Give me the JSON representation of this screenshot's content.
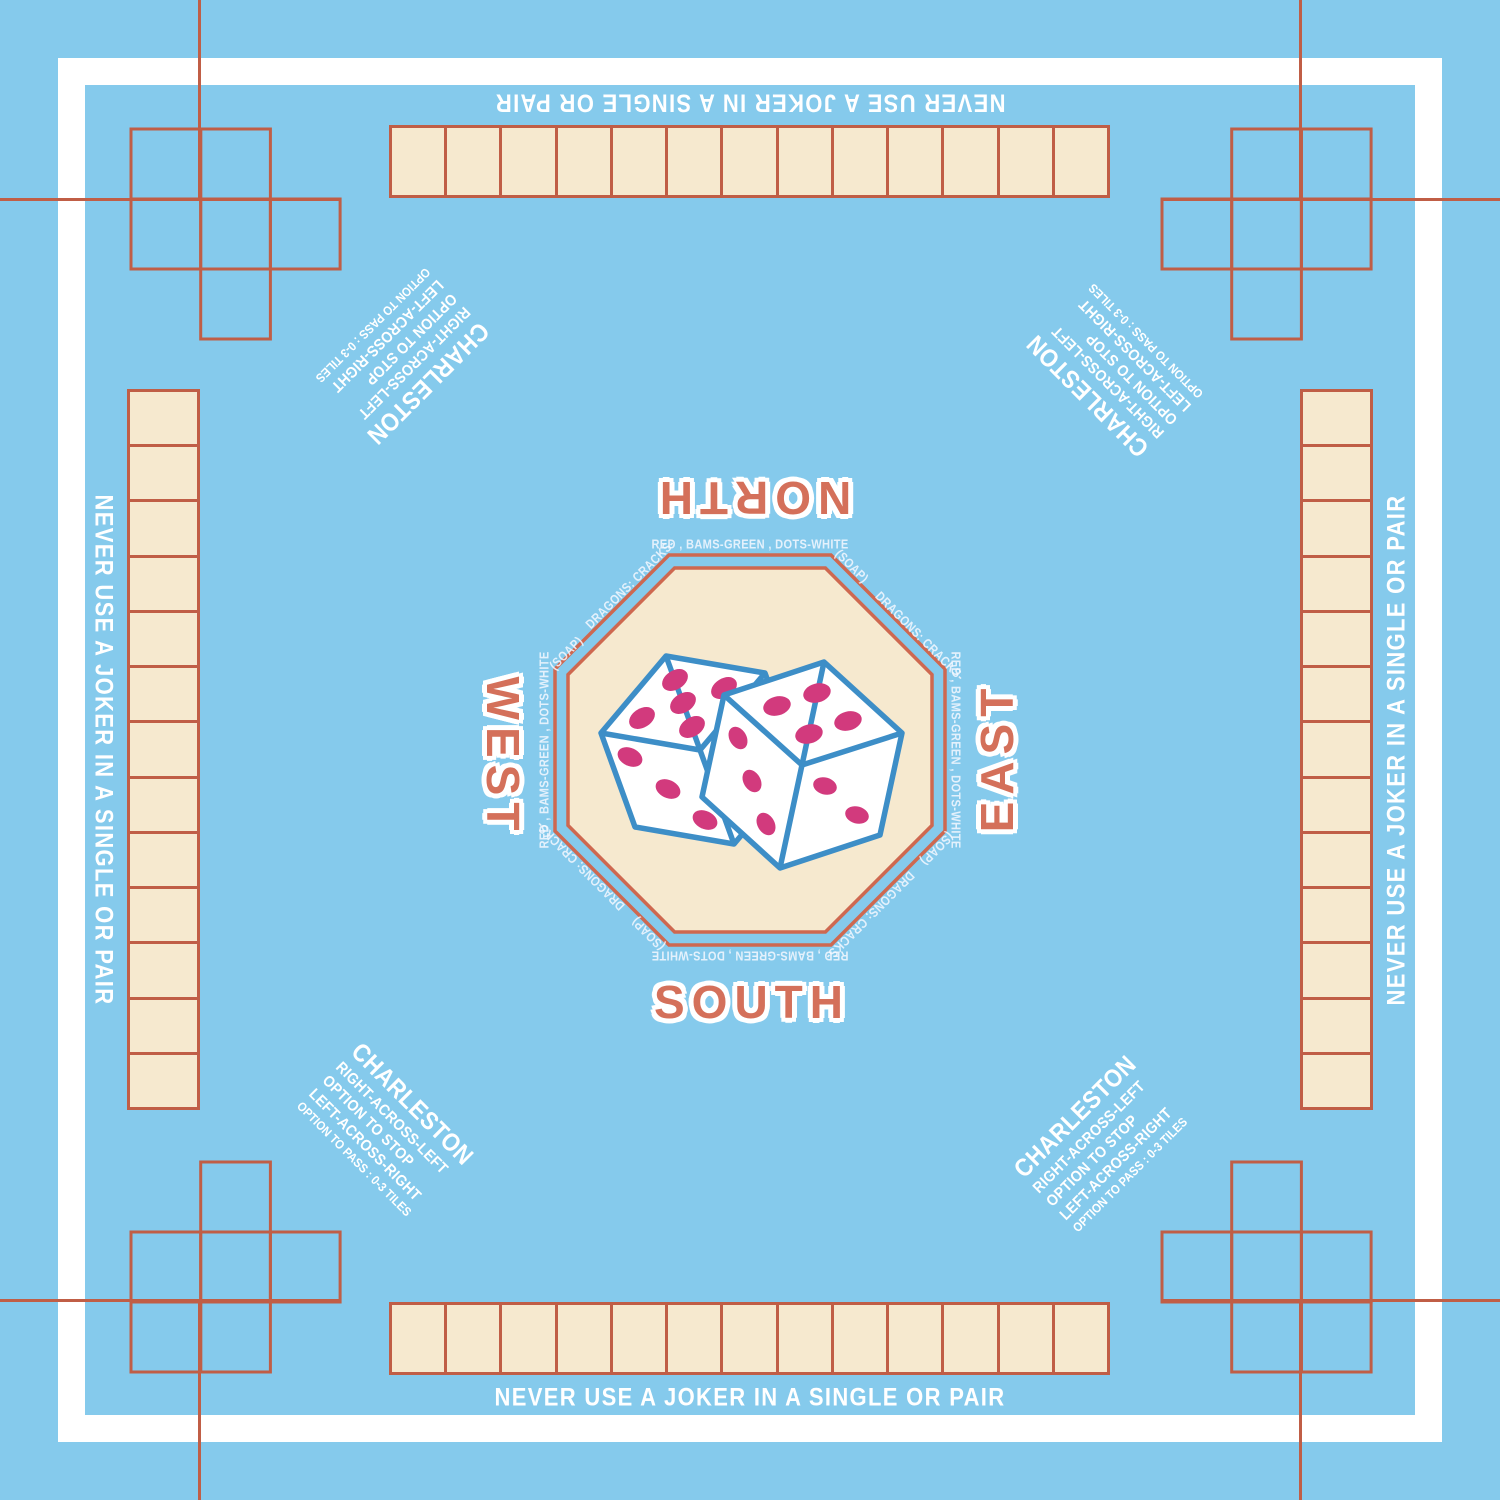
{
  "colors": {
    "background": "#85CAEC",
    "line": "#C05E46",
    "cream": "#F6E9CF",
    "label": "#D4705A",
    "rim": "#CE6850",
    "dice_outline": "#3D8EC7",
    "pip": "#D23A7D",
    "ring_text": "rgba(245,248,255,0.85)"
  },
  "warning": {
    "text": "NEVER USE A JOKER IN A SINGLE OR PAIR"
  },
  "labels": {
    "north": "NORTH",
    "south": "SOUTH",
    "east": "EAST",
    "west": "WEST"
  },
  "charleston": {
    "title": "CHARLESTON",
    "line1": "RIGHT-ACROSS-LEFT",
    "line2": "OPTION TO STOP",
    "line3": "LEFT-ACROSS-RIGHT",
    "line4": "OPTION TO PASS :   0-3 TILES"
  },
  "ring": {
    "edge": "RED , BAMS-GREEN , DOTS-WHITE",
    "prefix": "DRAGONS: CRACKS-",
    "suffix": "(SOAP)"
  },
  "racks": {
    "tile_count": 13
  },
  "dice": {
    "left_die": {
      "top_face_pips": 5,
      "side_face_pips": 3
    },
    "right_die": {
      "top_face_pips": 4,
      "left_face_pips": 3,
      "right_face_pips": 2
    }
  }
}
